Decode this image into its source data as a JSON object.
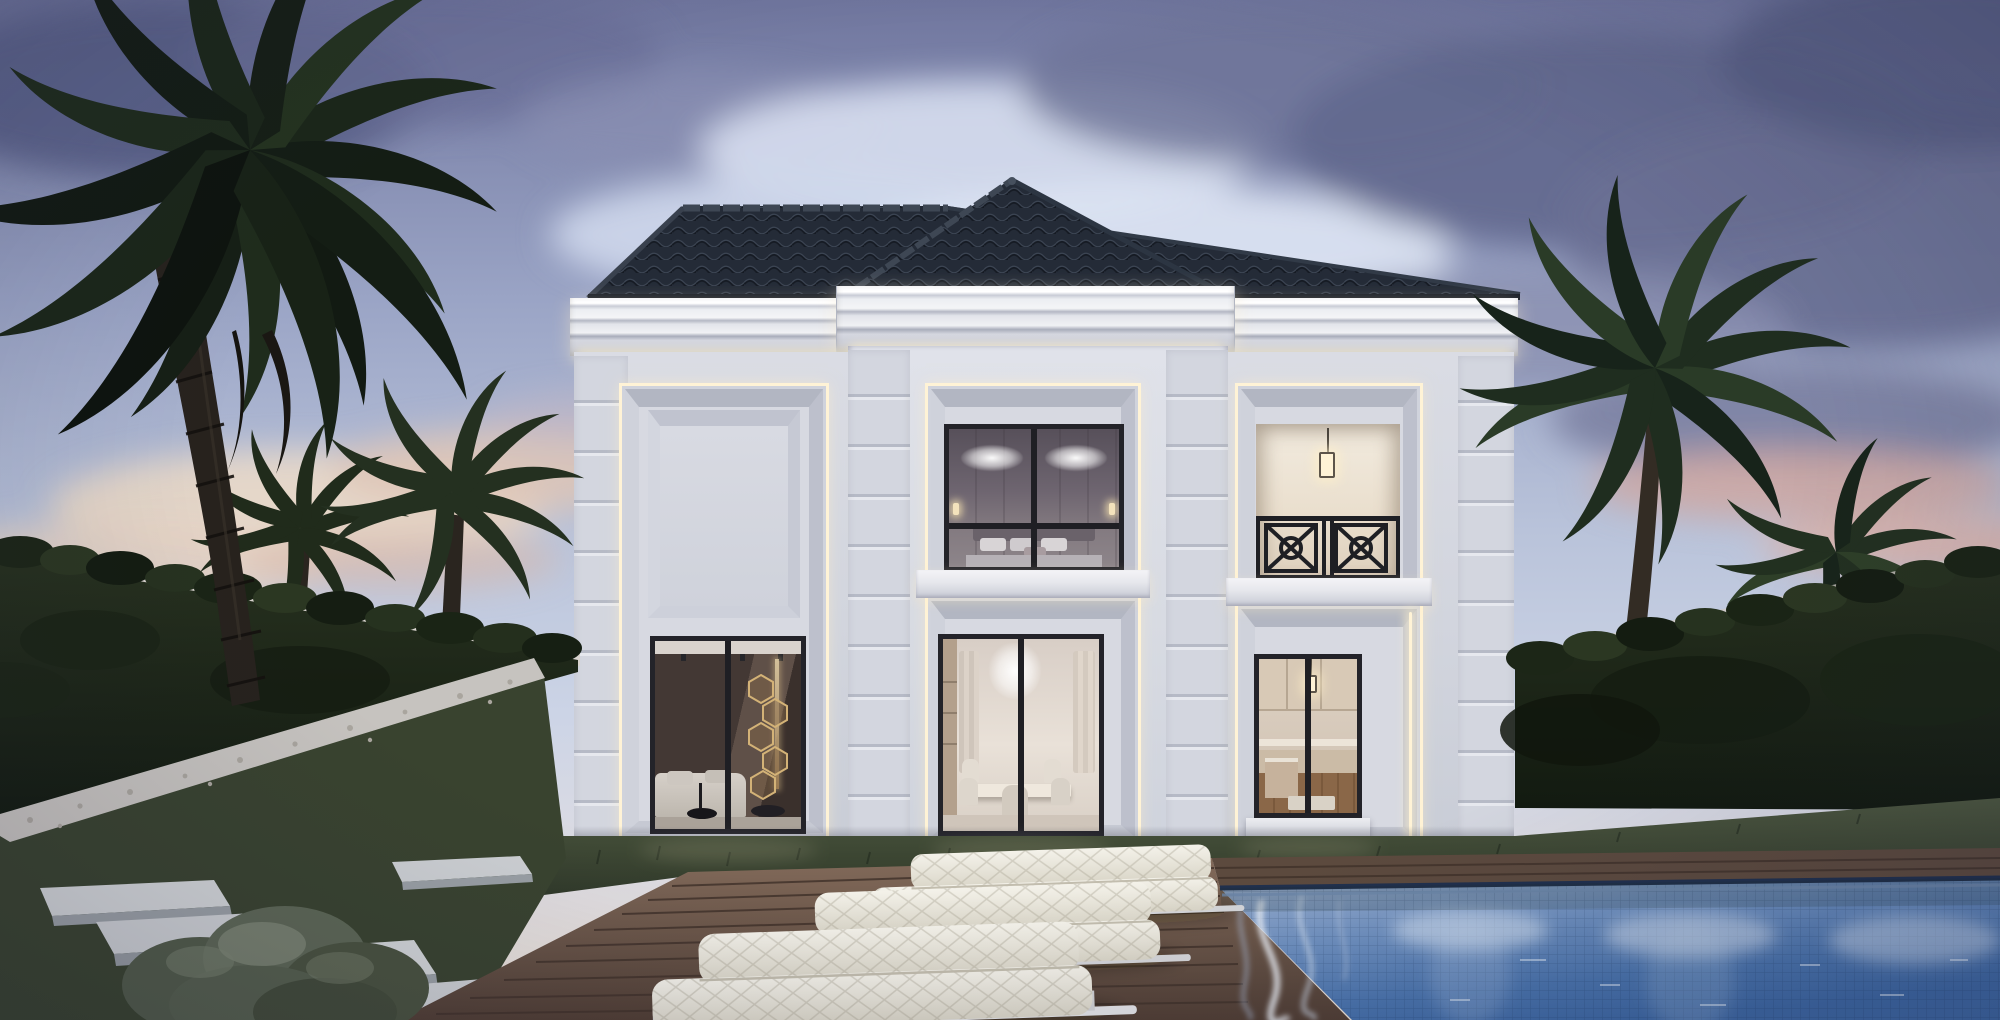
{
  "meta": {
    "title": "Photorealistic 3D rendering of a luxury neo-classical two-storey villa at dusk, with palm trees, ivy-covered garden walls, timber pool deck, white sun loungers and a mosaic-tiled swimming pool",
    "type": "architectural exterior rendering",
    "time_of_day": "dusk"
  },
  "palette": {
    "skyTop": "#70769e",
    "skyMid": "#9ba5c6",
    "skyLow": "#ccd4e6",
    "horizon": "#eee3d6",
    "cloudDark": "#646a90",
    "cloudLight": "#e2e8f4",
    "cloudPink": "#d2aba6",
    "roofTile": "#242b37",
    "roofRidge": "#3e4754",
    "corniceLight": "#f4f5f7",
    "wall": "#d5d8e1",
    "wallShade": "#c6c9d4",
    "led": "#fff3d6",
    "frameDark": "#232329",
    "hedgeDark": "#1a2418",
    "hedgeLight": "#2f3d26",
    "palmDark": "#141d14",
    "palmMid": "#243420",
    "trunk": "#2b2620",
    "grass": "#46513c",
    "grassDark": "#2c3526",
    "stone": "#d2d5d7",
    "pebble": "#c6c3bf",
    "deck": "#7d675a",
    "deckDark": "#503e34",
    "pool": "#5c82b8",
    "poolDeep": "#3d68a4",
    "poolLight": "#9db0cf",
    "cushion": "#eeebe1",
    "metal": "#d7d8da"
  },
  "scene": {
    "sky": "Purple-blue dusk sky, scattered dark clouds above, bright silver clouds mid-height, warm pink-cream sunset glow at the horizon",
    "house": {
      "style": "neo-classical villa, light grey stucco, projecting centre bay",
      "floors": 2,
      "roof": "dark charcoal scalloped-tile hip roof with raised centre hip",
      "lighting": "warm LED cove strips under cornices and around every recessed window bay",
      "openings": [
        {
          "id": "upper-left-panel",
          "content": "blank recessed bevelled panel"
        },
        {
          "id": "upper-center-window",
          "room": "bedroom",
          "content": "two crystal chandeliers, panelled wall, upholstered bed with pillows"
        },
        {
          "id": "upper-right-loggia",
          "room": "balcony loggia",
          "content": "pendant lantern, black geometric X-motif railing"
        },
        {
          "id": "lower-left-window",
          "room": "living room",
          "content": "dark feature wall, column of gold hexagonal mirrors, white sectional sofa, black round tables"
        },
        {
          "id": "lower-center-window",
          "room": "dining room",
          "content": "cascading chandelier, long dining table with upholstered chairs, curtains"
        },
        {
          "id": "lower-right-window",
          "room": "kitchen",
          "content": "cream classic cabinetry, pendant lantern, timber floor"
        }
      ]
    },
    "landscape": {
      "palm_trees": 5,
      "left": "large foreground date palm and two smaller palms behind the ivy wall",
      "right": "two palms behind the ivy wall",
      "hedges": "ivy-clad white boundary walls on both sides",
      "lawn": "dark green grass strip at the facade",
      "path": "floating pale concrete slab steps",
      "pebbles": "white pebble border along the left hedge",
      "bush": "round clipped grey-green shrub, bottom left"
    },
    "pool_area": {
      "deck": "brown timber plank deck",
      "loungers": 3,
      "lounger_style": "white quilted cushion sun loungers on pale metal frames",
      "pool": "mosaic-tiled pool with three underwater lights and white caustic reflections"
    }
  }
}
